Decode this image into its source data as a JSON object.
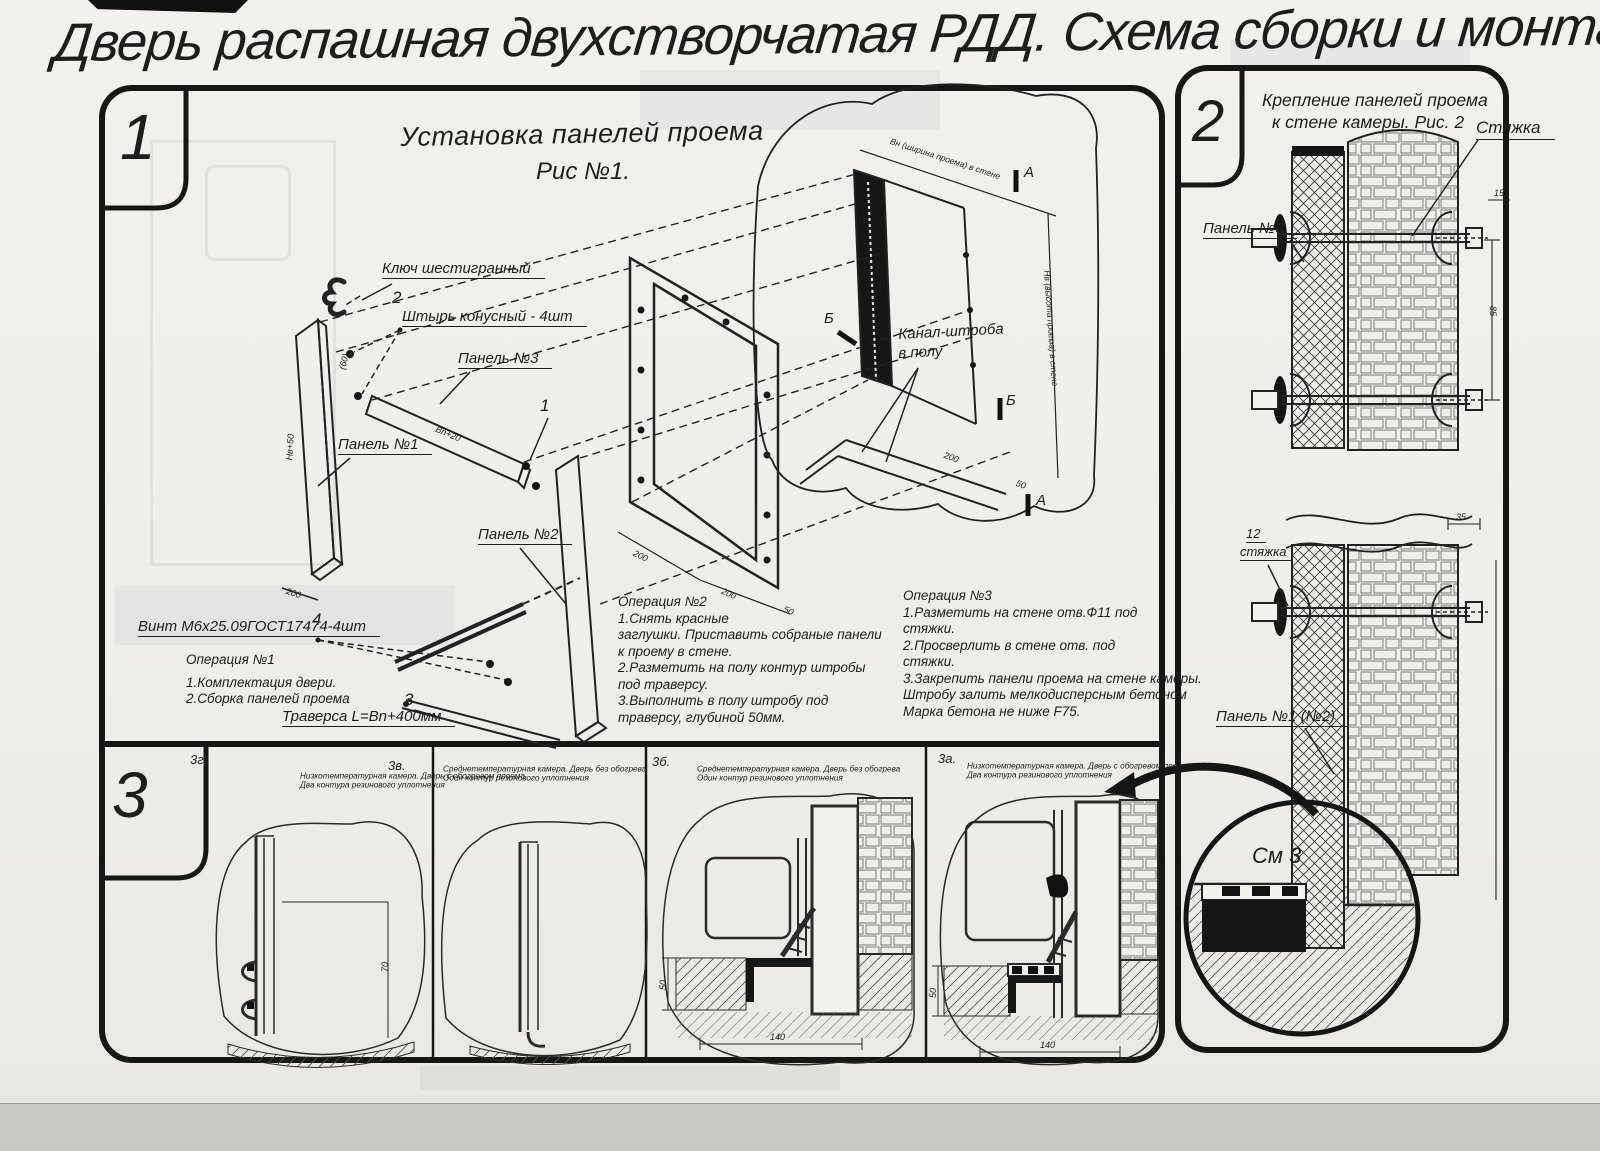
{
  "title": "Дверь распашная двухстворчатая РДД.  Схема сборки и монтажа №2",
  "section1": {
    "badge": "1",
    "heading1": "Установка панелей проема",
    "heading2": "Рис №1.",
    "callouts": {
      "hex_key": "Ключ шестигранный",
      "pin_no": "2",
      "pin": "Штырь конусный - 4шт",
      "panel3": "Панель №3",
      "panel1": "Панель №1",
      "no1": "1",
      "panel2": "Панель №2",
      "screw_no": "4",
      "screw": "Винт М6х25.09ГОСТ17474-4шт",
      "traverse_no": "3",
      "traverse": "Траверса  L=Bn+400мм",
      "channel1": "Канал-штроба",
      "channel2": "в полу",
      "marker_a": "А",
      "marker_b": "Б"
    },
    "dims": {
      "panel_w": "200",
      "panel_h": "Нв+50",
      "gap": "(60)",
      "bar_len": "Вn+20",
      "frame_b1": "200",
      "frame_b2": "200",
      "frame_b3": "50",
      "wall_w": "Вн (ширина проема) в стене",
      "wall_h": "Нв (высота проема) в стене",
      "chan1": "200",
      "chan2": "50"
    },
    "op1": {
      "title": "Операция №1",
      "l1": "1.Комплектация двери.",
      "l2": "2.Сборка панелей проема"
    },
    "op2": {
      "title": "Операция №2",
      "l1": "1.Снять красные",
      "l2": "заглушки. Приставить собраные панели",
      "l3": "к проему в стене.",
      "l4": "2.Разметить на полу контур штробы",
      "l5": "под траверсу.",
      "l6": "3.Выполнить в полу штробу под",
      "l7": "траверсу, глубиной 50мм."
    },
    "op3": {
      "title": "Операция №3",
      "l1": "1.Разметить на стене отв.Ф11 под",
      "l2": "стяжки.",
      "l3": "2.Просверлить в стене отв.   под",
      "l4": "стяжки.",
      "l5": "3.Закрепить панели проема на стене камеры.",
      "l6": "Штробу залить мелкодисперсным бетоном",
      "l7": "Марка бетона не ниже   F75."
    }
  },
  "section2": {
    "badge": "2",
    "heading1": "Крепление панелей проема",
    "heading2": "к стене камеры. Рис. 2",
    "callouts": {
      "tie": "Стяжка",
      "panel3": "Панель №3",
      "tie_no": "12",
      "tie_small": "стяжка",
      "panel12": "Панель №1 (№2)",
      "see": "См 3"
    },
    "dims": {
      "d15": "15",
      "d85": "85",
      "d35": "35"
    }
  },
  "section3": {
    "badge": "3",
    "panels": [
      {
        "label": "3г.",
        "cap1": "Низкотемпературная камера. Дверь с обогревом проема",
        "cap2": "Два контура резинового уплотнения",
        "dim1": "70",
        "dim2": ""
      },
      {
        "label": "3в.",
        "cap1": "Среднетемпературная камера. Дверь без обогрева",
        "cap2": "Один контур резинового уплотнения",
        "dim1": "",
        "dim2": ""
      },
      {
        "label": "3б.",
        "cap1": "Среднетемпературная камера. Дверь без обогрева",
        "cap2": "Один контур резинового уплотнения",
        "dim1": "50",
        "dim2": "140"
      },
      {
        "label": "3а.",
        "cap1": "Низкотемпературная камера. Дверь с обогревом проема и порога",
        "cap2": "Два контура резинового уплотнения",
        "dim1": "50",
        "dim2": "140"
      }
    ]
  }
}
